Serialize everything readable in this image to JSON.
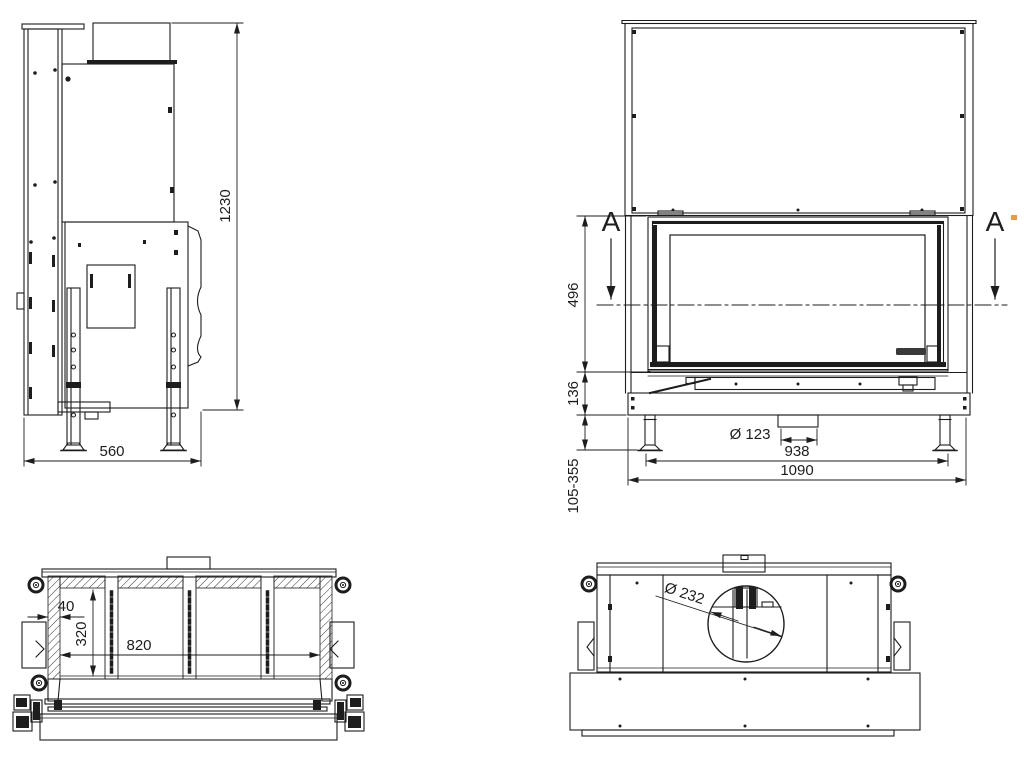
{
  "palette": {
    "background": "#ffffff",
    "ink": "#1d1d1d",
    "artifact_orange": "#e79b4a"
  },
  "views": {
    "side_view": {
      "overall_height": "1230",
      "overall_depth": "560"
    },
    "front_view": {
      "section_letter": "A",
      "glass_opening_height": "496",
      "plinth_height": "136",
      "leg_adjust_range": "105-355",
      "intake_diameter": "Ø 123",
      "feet_spacing": "938",
      "overall_width": "1090"
    },
    "section_a_a": {
      "wall_thickness": "40",
      "chamber_depth": "320",
      "chamber_width": "820"
    },
    "top_view": {
      "flue_diameter": "Ø 232"
    }
  }
}
